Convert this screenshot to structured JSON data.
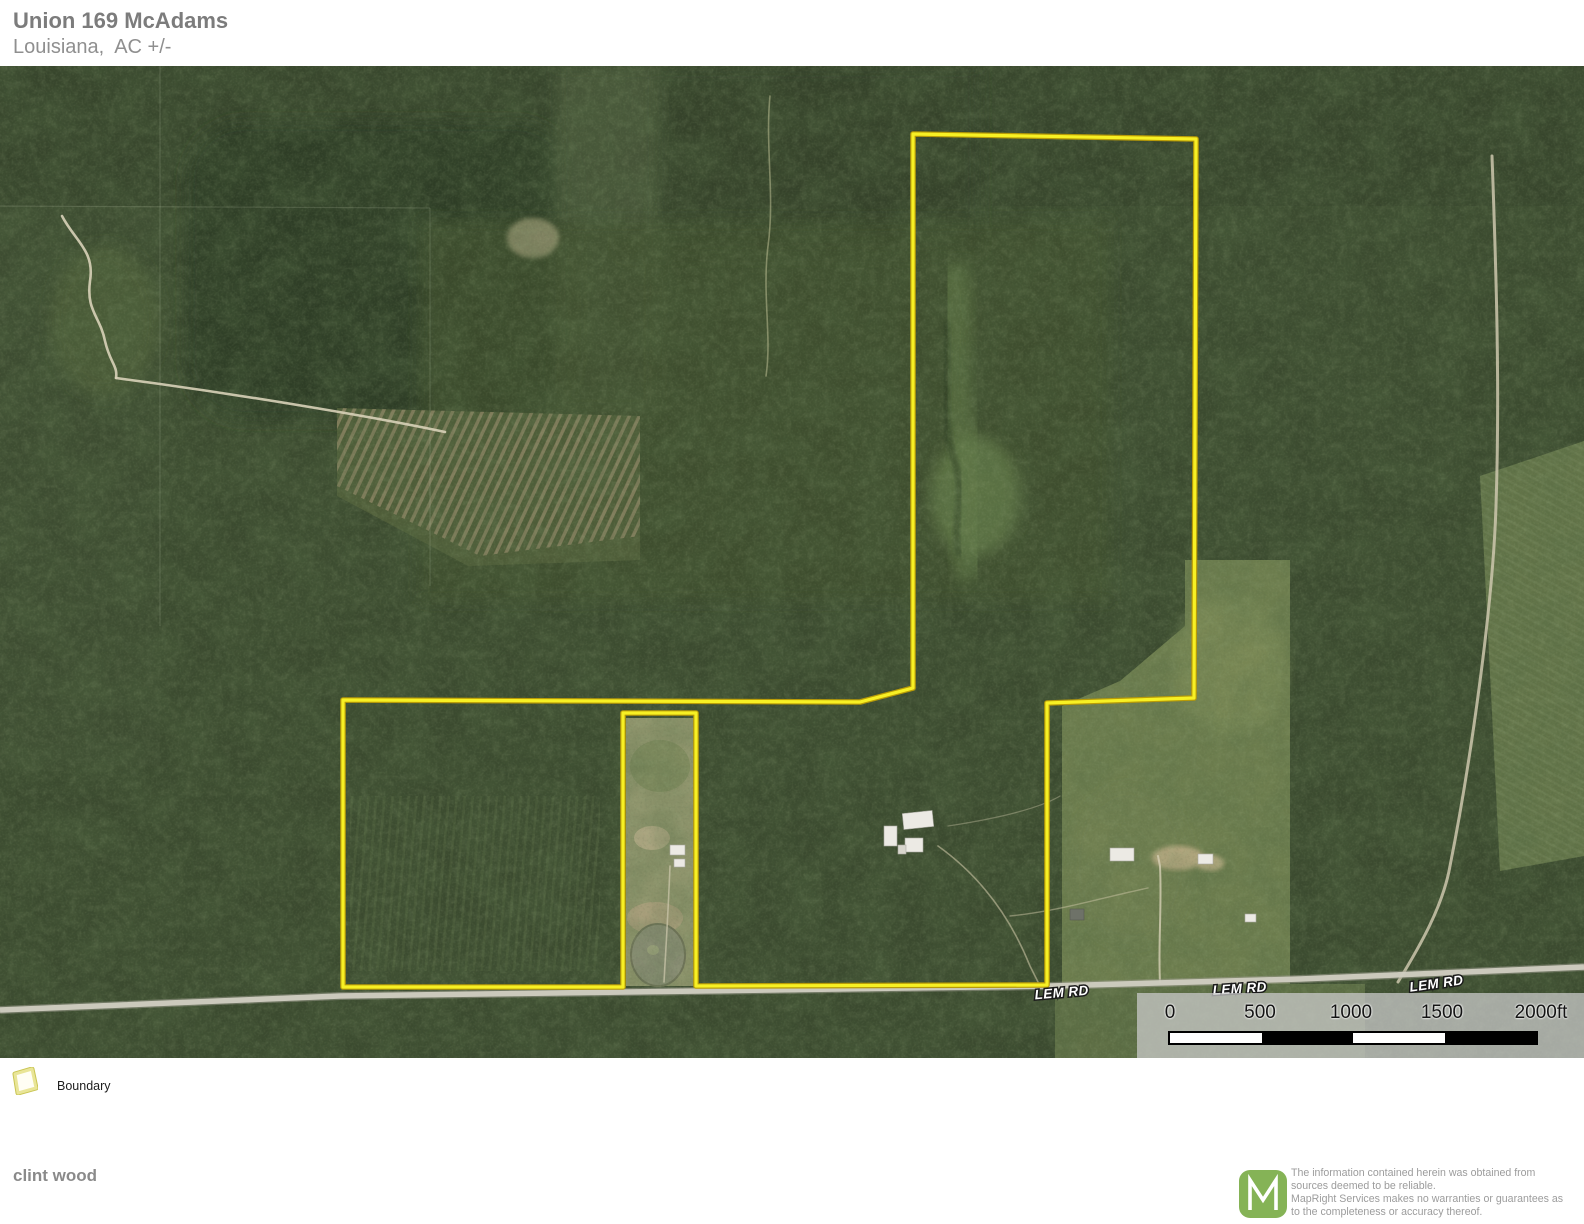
{
  "header": {
    "title": "Union 169 McAdams",
    "subtitle": "Louisiana,  AC +/-"
  },
  "map": {
    "road_labels": [
      {
        "text": "LEM RD"
      },
      {
        "text": "LEM RD"
      },
      {
        "text": "LEM RD"
      }
    ],
    "scale_bar": {
      "ticks": [
        "0",
        "500",
        "1000",
        "1500",
        "2000ft"
      ]
    },
    "boundary_color": "#f7f024"
  },
  "legend": {
    "boundary_label": "Boundary",
    "swatch_color": "#e3df7d"
  },
  "footer": {
    "author": "clint wood",
    "logo_letter": "M",
    "logo_color": "#85b356",
    "disclaimer": "The information contained herein was obtained from sources deemed to be reliable.\n MapRight Services makes no warranties or guarantees as to the completeness or accuracy thereof."
  }
}
